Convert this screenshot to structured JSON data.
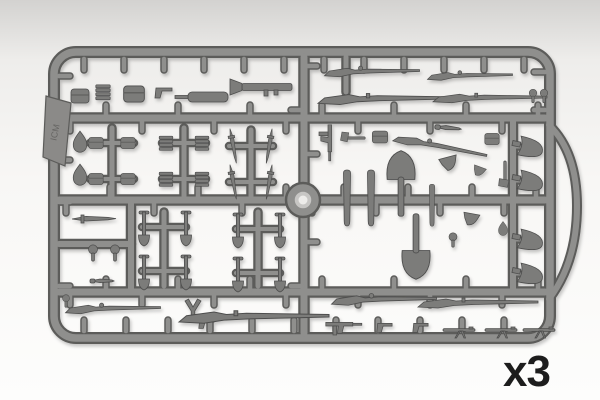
{
  "scene": {
    "description": "Photograph of a gray injection-molded plastic model kit sprue with WWII infantry weapons and equipment parts",
    "quantity_label": "x3",
    "logo_text": "ICM"
  },
  "colors": {
    "background_top": "#d3d2d0",
    "background_upper": "#eeedeb",
    "background_mid": "#f8f7f5",
    "background_bottom": "#fdfdfc",
    "sprue_dark": "#5c5c5a",
    "sprue_light": "#8f8f8d",
    "part_fill": "#7c7c7a",
    "part_stroke": "#4e4e4d",
    "hub_mid": "#c7c6c4",
    "hub_center": "#edecea",
    "logo_plate": "#8b8a88",
    "logo_text_color": "#5f5e5c",
    "label_color": "#1d1d1d"
  },
  "sprue": {
    "frame": {
      "x": 54,
      "y": 52,
      "w": 496,
      "h": 286,
      "rx": 22
    },
    "bulge_path": "M549 125 Q577 152 577 206 Q577 262 549 299",
    "hub": {
      "cx": 303,
      "cy": 200,
      "r_outer": 17,
      "r_mid": 9,
      "r_center": 4.5
    },
    "logo_plate": {
      "points": "46,96 71,103 65,166 43,157",
      "text_x": 58,
      "text_y": 133,
      "rot": -78
    },
    "rails": [
      {
        "x1": 59,
        "y1": 118,
        "x2": 545,
        "y2": 118,
        "w": 9
      },
      {
        "x1": 59,
        "y1": 200,
        "x2": 545,
        "y2": 200,
        "w": 9
      },
      {
        "x1": 59,
        "y1": 292,
        "x2": 545,
        "y2": 292,
        "w": 9
      },
      {
        "x1": 304,
        "y1": 57,
        "x2": 304,
        "y2": 333,
        "w": 9
      },
      {
        "x1": 131,
        "y1": 200,
        "x2": 131,
        "y2": 292,
        "w": 8
      },
      {
        "x1": 59,
        "y1": 244,
        "x2": 131,
        "y2": 244,
        "w": 8
      },
      {
        "x1": 513,
        "y1": 118,
        "x2": 513,
        "y2": 292,
        "w": 8
      },
      {
        "x1": 346,
        "y1": 57,
        "x2": 346,
        "y2": 92,
        "w": 7
      },
      {
        "x1": 112,
        "y1": 128,
        "x2": 112,
        "y2": 196,
        "w": 7
      },
      {
        "x1": 184,
        "y1": 128,
        "x2": 184,
        "y2": 196,
        "w": 7
      },
      {
        "x1": 251,
        "y1": 130,
        "x2": 251,
        "y2": 196,
        "w": 7
      },
      {
        "x1": 90,
        "y1": 143,
        "x2": 134,
        "y2": 143,
        "w": 6
      },
      {
        "x1": 90,
        "y1": 179,
        "x2": 134,
        "y2": 179,
        "w": 6
      },
      {
        "x1": 162,
        "y1": 143,
        "x2": 206,
        "y2": 143,
        "w": 6
      },
      {
        "x1": 162,
        "y1": 179,
        "x2": 206,
        "y2": 179,
        "w": 6
      },
      {
        "x1": 229,
        "y1": 146,
        "x2": 273,
        "y2": 146,
        "w": 6
      },
      {
        "x1": 229,
        "y1": 182,
        "x2": 273,
        "y2": 182,
        "w": 6
      },
      {
        "x1": 164,
        "y1": 212,
        "x2": 164,
        "y2": 286,
        "w": 7
      },
      {
        "x1": 258,
        "y1": 212,
        "x2": 258,
        "y2": 286,
        "w": 7
      },
      {
        "x1": 142,
        "y1": 227,
        "x2": 186,
        "y2": 227,
        "w": 6
      },
      {
        "x1": 142,
        "y1": 271,
        "x2": 186,
        "y2": 271,
        "w": 6
      },
      {
        "x1": 236,
        "y1": 229,
        "x2": 280,
        "y2": 229,
        "w": 6
      },
      {
        "x1": 236,
        "y1": 273,
        "x2": 280,
        "y2": 273,
        "w": 6
      },
      {
        "x1": 513,
        "y1": 147,
        "x2": 523,
        "y2": 147,
        "w": 5
      },
      {
        "x1": 513,
        "y1": 181,
        "x2": 523,
        "y2": 181,
        "w": 5
      },
      {
        "x1": 513,
        "y1": 240,
        "x2": 523,
        "y2": 240,
        "w": 5
      },
      {
        "x1": 513,
        "y1": 274,
        "x2": 523,
        "y2": 274,
        "w": 5
      }
    ],
    "stub_lines": [
      {
        "x1": 84,
        "y1": 57,
        "x2": 528,
        "y2": 57,
        "side": "down",
        "spacing": 40
      },
      {
        "x1": 84,
        "y1": 333,
        "x2": 528,
        "y2": 333,
        "side": "up",
        "spacing": 42
      },
      {
        "x1": 57,
        "y1": 76,
        "x2": 57,
        "y2": 322,
        "side": "right",
        "spacing": 42
      },
      {
        "x1": 547,
        "y1": 72,
        "x2": 547,
        "y2": 112,
        "side": "left",
        "spacing": 38
      },
      {
        "x1": 70,
        "y1": 118,
        "x2": 538,
        "y2": 118,
        "side": "both",
        "spacing": 36
      },
      {
        "x1": 66,
        "y1": 200,
        "x2": 296,
        "y2": 200,
        "side": "both",
        "spacing": 44
      },
      {
        "x1": 312,
        "y1": 200,
        "x2": 538,
        "y2": 200,
        "side": "both",
        "spacing": 32
      },
      {
        "x1": 70,
        "y1": 292,
        "x2": 538,
        "y2": 292,
        "side": "both",
        "spacing": 36
      },
      {
        "x1": 304,
        "y1": 66,
        "x2": 304,
        "y2": 326,
        "side": "both",
        "spacing": 44
      }
    ]
  },
  "part_types_legend": {
    "rifle": "bolt-action rifle",
    "longrifle": "long rifle",
    "smg": "submachine gun",
    "pistol": "pistol",
    "bazooka": "rocket launcher",
    "canister": "cylindrical canister",
    "shovel": "entrenching shovel",
    "helmet": "helmet",
    "teardrop": "water flask",
    "pouch": "ammo pouch",
    "clipstack": "ammunition clip stack",
    "bayonet": "bayonet",
    "knife": "combat knife",
    "grenade": "grenade",
    "scabbard": "scabbard",
    "axe": "hatchet",
    "holster": "pistol holster",
    "spadesmall": "small entrenching tool",
    "ytool": "y-shaped bracket",
    "mgtiny": "machine gun with bipod"
  },
  "parts": [
    {
      "t": "pouch",
      "x": 80,
      "y": 96,
      "r": 0,
      "s": 1
    },
    {
      "t": "clipstack",
      "x": 103,
      "y": 92,
      "r": 0,
      "s": 0.9
    },
    {
      "t": "pouch",
      "x": 134,
      "y": 94,
      "r": 0,
      "s": 1.15
    },
    {
      "t": "pistol",
      "x": 163,
      "y": 92,
      "r": 0,
      "s": 1
    },
    {
      "t": "canister",
      "x": 208,
      "y": 97,
      "r": 0,
      "s": 1
    },
    {
      "t": "bazooka",
      "x": 266,
      "y": 87,
      "r": 0,
      "s": 1
    },
    {
      "t": "rifle",
      "x": 372,
      "y": 72,
      "r": 0,
      "s": 0.95
    },
    {
      "t": "rifle",
      "x": 470,
      "y": 76,
      "r": 0,
      "s": 0.85
    },
    {
      "t": "longrifle",
      "x": 384,
      "y": 99,
      "r": 0,
      "s": 1.1
    },
    {
      "t": "longrifle",
      "x": 490,
      "y": 98,
      "r": 0,
      "s": 0.95
    },
    {
      "t": "grenade",
      "x": 533,
      "y": 96,
      "r": 0,
      "s": 0.75
    },
    {
      "t": "grenade",
      "x": 544,
      "y": 96,
      "r": 0,
      "s": 0.75
    },
    {
      "t": "smg",
      "x": 328,
      "y": 141,
      "r": 90,
      "s": 0.9
    },
    {
      "t": "axe",
      "x": 354,
      "y": 138,
      "r": 0,
      "s": 0.75
    },
    {
      "t": "pouch",
      "x": 380,
      "y": 137,
      "r": 0,
      "s": 0.85
    },
    {
      "t": "rifle",
      "x": 440,
      "y": 147,
      "r": 12,
      "s": 0.95
    },
    {
      "t": "knife",
      "x": 448,
      "y": 128,
      "r": 5,
      "s": 1.1
    },
    {
      "t": "pouch",
      "x": 492,
      "y": 139,
      "r": 0,
      "s": 0.8
    },
    {
      "t": "scabbard",
      "x": 347,
      "y": 199,
      "r": 0,
      "s": 1
    },
    {
      "t": "scabbard",
      "x": 371,
      "y": 199,
      "r": 0,
      "s": 1
    },
    {
      "t": "shovel",
      "x": 401,
      "y": 184,
      "r": 0,
      "s": 1.15
    },
    {
      "t": "shovel",
      "x": 416,
      "y": 246,
      "r": 180,
      "s": 1.15
    },
    {
      "t": "scabbard",
      "x": 432,
      "y": 206,
      "r": 0,
      "s": 0.75
    },
    {
      "t": "holster",
      "x": 449,
      "y": 163,
      "r": -15,
      "s": 1
    },
    {
      "t": "holster",
      "x": 471,
      "y": 219,
      "r": 10,
      "s": 0.9
    },
    {
      "t": "grenade",
      "x": 453,
      "y": 240,
      "r": 0,
      "s": 0.8
    },
    {
      "t": "axe",
      "x": 505,
      "y": 173,
      "r": -90,
      "s": 0.8
    },
    {
      "t": "holster",
      "x": 479,
      "y": 171,
      "r": 20,
      "s": 0.7
    },
    {
      "t": "teardrop",
      "x": 503,
      "y": 228,
      "r": 0,
      "s": 0.6
    },
    {
      "t": "helmet",
      "x": 529,
      "y": 147,
      "r": 12,
      "s": 1
    },
    {
      "t": "helmet",
      "x": 529,
      "y": 181,
      "r": 12,
      "s": 1
    },
    {
      "t": "helmet",
      "x": 529,
      "y": 240,
      "r": 12,
      "s": 1
    },
    {
      "t": "helmet",
      "x": 529,
      "y": 274,
      "r": 12,
      "s": 1
    },
    {
      "t": "teardrop",
      "x": 80,
      "y": 141,
      "r": 0,
      "s": 0.9
    },
    {
      "t": "teardrop",
      "x": 80,
      "y": 174,
      "r": 0,
      "s": 0.9
    },
    {
      "t": "pouch",
      "x": 96,
      "y": 143,
      "r": 0,
      "s": 0.8
    },
    {
      "t": "pouch",
      "x": 128,
      "y": 143,
      "r": 0,
      "s": 0.8
    },
    {
      "t": "pouch",
      "x": 96,
      "y": 179,
      "r": 0,
      "s": 0.8
    },
    {
      "t": "pouch",
      "x": 128,
      "y": 179,
      "r": 0,
      "s": 0.8
    },
    {
      "t": "clipstack",
      "x": 166,
      "y": 143,
      "r": 0,
      "s": 0.85
    },
    {
      "t": "clipstack",
      "x": 202,
      "y": 143,
      "r": 0,
      "s": 0.85
    },
    {
      "t": "clipstack",
      "x": 166,
      "y": 179,
      "r": 0,
      "s": 0.85
    },
    {
      "t": "clipstack",
      "x": 202,
      "y": 179,
      "r": 0,
      "s": 0.85
    },
    {
      "t": "bayonet",
      "x": 233,
      "y": 146,
      "r": 80,
      "s": 0.8
    },
    {
      "t": "bayonet",
      "x": 269,
      "y": 146,
      "r": 100,
      "s": 0.8
    },
    {
      "t": "bayonet",
      "x": 233,
      "y": 182,
      "r": 80,
      "s": 0.8
    },
    {
      "t": "bayonet",
      "x": 269,
      "y": 182,
      "r": 100,
      "s": 0.8
    },
    {
      "t": "bayonet",
      "x": 94,
      "y": 219,
      "r": 0,
      "s": 1
    },
    {
      "t": "grenade",
      "x": 93,
      "y": 253,
      "r": 0,
      "s": 0.9
    },
    {
      "t": "grenade",
      "x": 115,
      "y": 253,
      "r": 0,
      "s": 0.9
    },
    {
      "t": "knife",
      "x": 102,
      "y": 281,
      "r": 0,
      "s": 1
    },
    {
      "t": "spadesmall",
      "x": 144,
      "y": 227,
      "r": 0,
      "s": 1
    },
    {
      "t": "spadesmall",
      "x": 186,
      "y": 227,
      "r": 0,
      "s": 1
    },
    {
      "t": "spadesmall",
      "x": 144,
      "y": 271,
      "r": 0,
      "s": 1
    },
    {
      "t": "spadesmall",
      "x": 186,
      "y": 271,
      "r": 0,
      "s": 1
    },
    {
      "t": "spadesmall",
      "x": 238,
      "y": 229,
      "r": 0,
      "s": 1
    },
    {
      "t": "spadesmall",
      "x": 280,
      "y": 229,
      "r": 0,
      "s": 1
    },
    {
      "t": "spadesmall",
      "x": 238,
      "y": 273,
      "r": 0,
      "s": 1
    },
    {
      "t": "spadesmall",
      "x": 280,
      "y": 273,
      "r": 0,
      "s": 1
    },
    {
      "t": "grenade",
      "x": 66,
      "y": 301,
      "r": 0,
      "s": 0.7
    },
    {
      "t": "rifle",
      "x": 113,
      "y": 309,
      "r": 0,
      "s": 0.95
    },
    {
      "t": "ytool",
      "x": 193,
      "y": 310,
      "r": 0,
      "s": 1
    },
    {
      "t": "pistol",
      "x": 206,
      "y": 323,
      "r": 0,
      "s": 0.9
    },
    {
      "t": "longrifle",
      "x": 254,
      "y": 317,
      "r": 0,
      "s": 1.25
    },
    {
      "t": "rifle",
      "x": 384,
      "y": 300,
      "r": 0,
      "s": 1.05
    },
    {
      "t": "longrifle",
      "x": 478,
      "y": 303,
      "r": 0,
      "s": 1.0
    },
    {
      "t": "smg",
      "x": 342,
      "y": 326,
      "r": 0,
      "s": 0.9
    },
    {
      "t": "pistol",
      "x": 384,
      "y": 327,
      "r": 0,
      "s": 0.9
    },
    {
      "t": "pistol",
      "x": 420,
      "y": 327,
      "r": 0,
      "s": 0.9
    },
    {
      "t": "mgtiny",
      "x": 459,
      "y": 330,
      "r": 0,
      "s": 1
    },
    {
      "t": "mgtiny",
      "x": 501,
      "y": 330,
      "r": 0,
      "s": 1
    },
    {
      "t": "mgtiny",
      "x": 539,
      "y": 330,
      "r": 0,
      "s": 1
    }
  ]
}
